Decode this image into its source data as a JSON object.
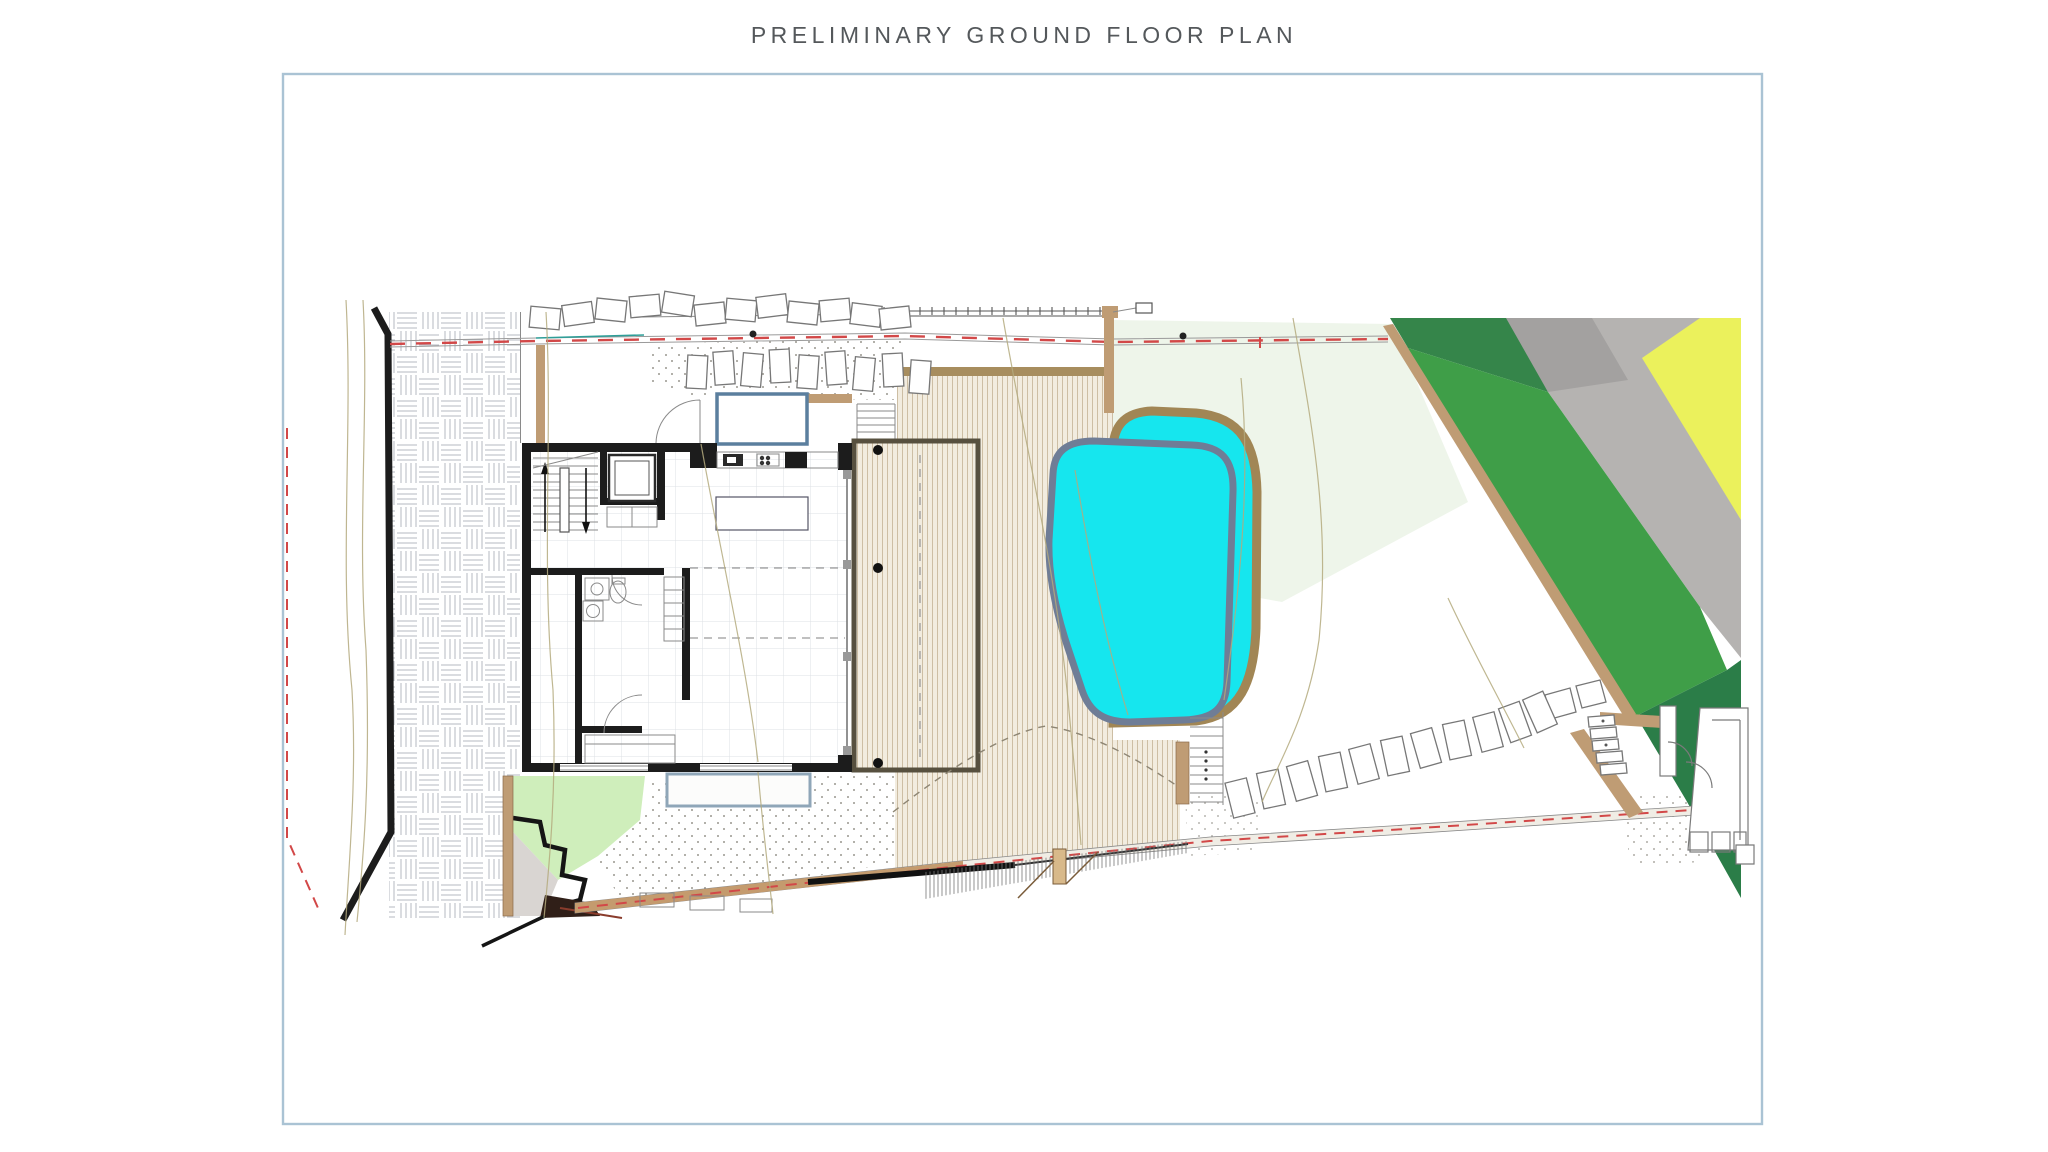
{
  "page": {
    "title": "PRELIMINARY GROUND FLOOR PLAN"
  },
  "palette": {
    "title_color": "#54585b",
    "frame_border": "#aac3d4",
    "pool_water": "#16e6ee",
    "pool_rim": "#6f7d96",
    "pool_coping": "#a18655",
    "deck_bg": "#f2ecdf",
    "deck_stripe": "#c9b99e",
    "deck_edge": "#a78d5e",
    "wall_black": "#1c1c1c",
    "pergola_brown": "#57503f",
    "paver_line": "#b6bac2",
    "tile_line": "#dde1e4",
    "lawn_pale": "#eef5ea",
    "lawn_medium": "#3f9e48",
    "lawn_dark_top": "#35854a",
    "lawn_dark_bottom": "#2b7d48",
    "drive_gray": "#b5b3b1",
    "drive_gray_dark": "#a3a1a0",
    "slope_yellow": "#ebf15c",
    "earth_tan": "#bf9c74",
    "ramp_tan": "#c49b6e",
    "boundary_red": "#d24848",
    "contour_olive": "#b4aa7e",
    "stipple_gray": "#9a978f",
    "scarp_green": "#cfeebb",
    "scarp_gray": "#d9d5d2",
    "skylight_blue": "#5b7f9e",
    "well_blue": "#8fa6b8",
    "stone_outline": "#777777",
    "fence_gray": "#555555",
    "teal_line": "#2f9e98",
    "post_tan": "#d8b98a"
  },
  "plan": {
    "drawing_type": "architectural site / ground floor plan",
    "features": [
      "driveway-pavers",
      "site-boundary-wall",
      "property-line-red-dashed",
      "residence-floor-plan",
      "internal-stair",
      "elevator",
      "bathroom",
      "kitchen-counter",
      "kitchen-island",
      "skylight",
      "light-well",
      "timber-deck",
      "pergola-outline",
      "swimming-pool",
      "pool-outer-shell",
      "stepping-stones",
      "lawn-terrace-medium",
      "lawn-terrace-dark",
      "gravel-driveway-band",
      "yellow-slope-bank",
      "outdoor-stairs",
      "entry-structure",
      "ramp-path",
      "retaining-wall",
      "contour-lines",
      "fence-line",
      "timber-post"
    ]
  }
}
